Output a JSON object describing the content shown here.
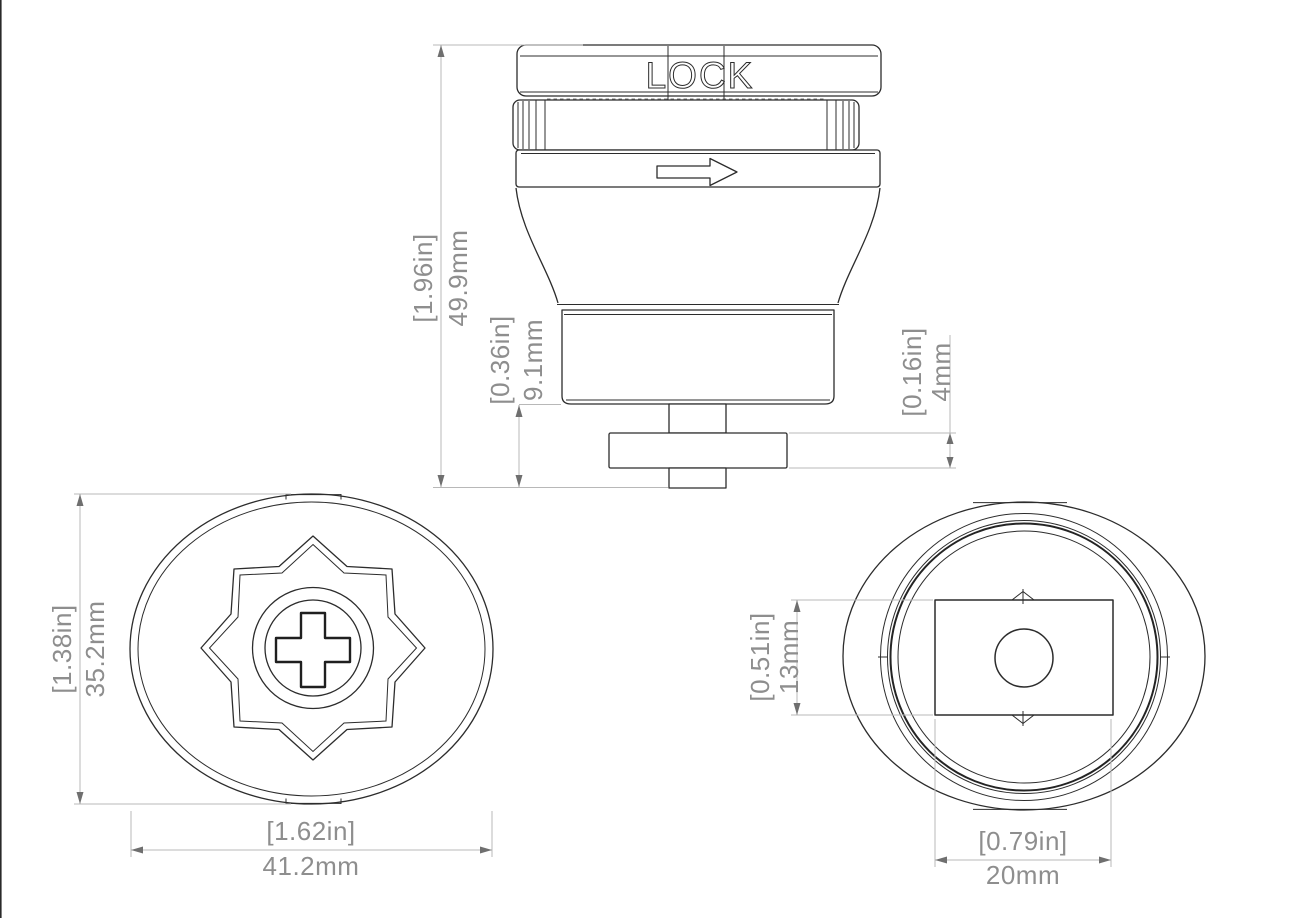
{
  "side_view": {
    "lock_label": "LOCK",
    "overall_height": {
      "inches": "[1.96in]",
      "mm": "49.9mm"
    },
    "base_height": {
      "inches": "[0.36in]",
      "mm": "9.1mm"
    },
    "cam_thickness": {
      "inches": "[0.16in]",
      "mm": "4mm"
    }
  },
  "front_view": {
    "face_height": {
      "inches": "[1.38in]",
      "mm": "35.2mm"
    },
    "face_width": {
      "inches": "[1.62in]",
      "mm": "41.2mm"
    }
  },
  "back_view": {
    "slot_height": {
      "inches": "[0.51in]",
      "mm": "13mm"
    },
    "slot_width": {
      "inches": "[0.79in]",
      "mm": "20mm"
    }
  },
  "colors": {
    "background": "#ffffff",
    "part_line": "#2c2c2c",
    "dimension_line": "#b8b8b8",
    "dimension_text": "#8e8e8e",
    "arrowhead": "#6f6f6f"
  }
}
